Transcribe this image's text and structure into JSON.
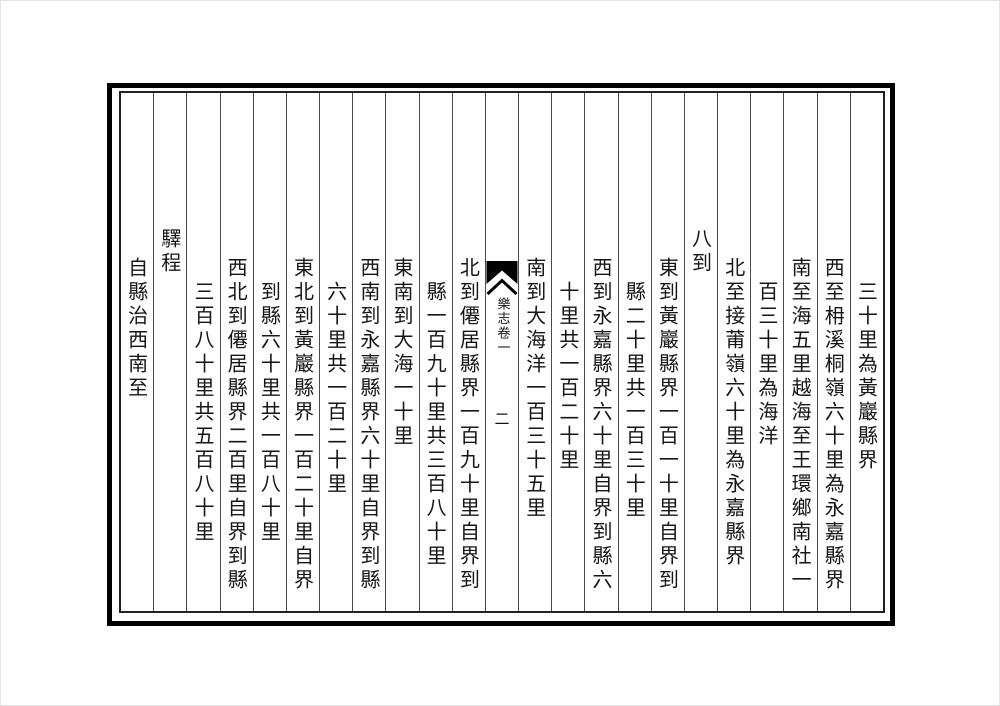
{
  "page": {
    "background": "#ffffff",
    "outer_border_color": "#000000",
    "inner_frame_color": "#222222",
    "rule_color": "#4a4a4a",
    "text_color": "#161616"
  },
  "fold_column": {
    "fishtail_icon": "fishtail-mark",
    "title": "樂志卷一",
    "page_number": "二"
  },
  "columns": [
    {
      "indent": "continuation",
      "text": "三十里為黃巖縣界"
    },
    {
      "indent": "entry",
      "text": "西至枏溪桐嶺六十里為永嘉縣界"
    },
    {
      "indent": "entry",
      "text": "南至海五里越海至王環鄉南社一"
    },
    {
      "indent": "continuation",
      "text": "百三十里為海洋"
    },
    {
      "indent": "entry",
      "text": "北至接莆嶺六十里為永嘉縣界"
    },
    {
      "indent": "heading",
      "text": "八到"
    },
    {
      "indent": "entry",
      "text": "東到黃巖縣界一百一十里自界到"
    },
    {
      "indent": "continuation",
      "text": "縣二十里共一百三十里"
    },
    {
      "indent": "entry",
      "text": "西到永嘉縣界六十里自界到縣六"
    },
    {
      "indent": "continuation",
      "text": "十里共一百二十里"
    },
    {
      "indent": "entry",
      "text": "南到大海洋一百三十五里"
    },
    {
      "indent": "fold",
      "text": ""
    },
    {
      "indent": "entry",
      "text": "北到僊居縣界一百九十里自界到"
    },
    {
      "indent": "continuation",
      "text": "縣一百九十里共三百八十里"
    },
    {
      "indent": "entry",
      "text": "東南到大海一十里"
    },
    {
      "indent": "entry",
      "text": "西南到永嘉縣界六十里自界到縣"
    },
    {
      "indent": "continuation",
      "text": "六十里共一百二十里"
    },
    {
      "indent": "entry",
      "text": "東北到黃巖縣界一百二十里自界"
    },
    {
      "indent": "continuation",
      "text": "到縣六十里共一百八十里"
    },
    {
      "indent": "entry",
      "text": "西北到僊居縣界二百里自界到縣"
    },
    {
      "indent": "continuation",
      "text": "三百八十里共五百八十里"
    },
    {
      "indent": "heading",
      "text": "驛程"
    },
    {
      "indent": "entry",
      "text": "自縣治西南至"
    }
  ]
}
